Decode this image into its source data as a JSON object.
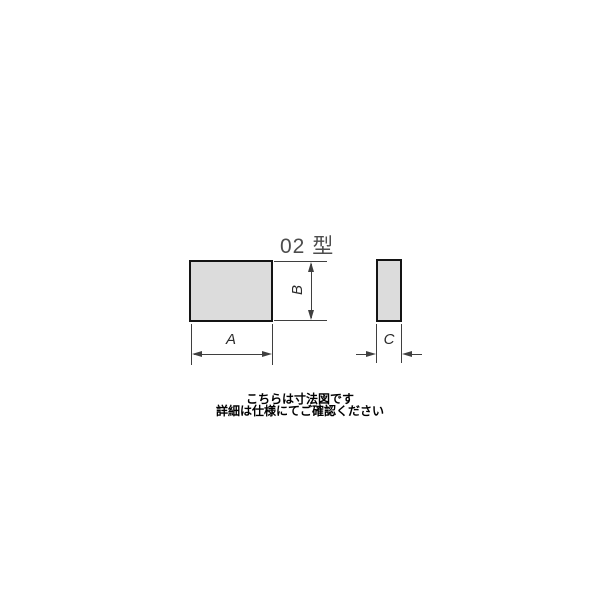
{
  "diagram": {
    "title": "02 型",
    "labels": {
      "width": "A",
      "height": "B",
      "thickness": "C"
    },
    "caption_line1": "こちらは寸法図です",
    "caption_line2": "詳細は仕様にてご確認ください",
    "colors": {
      "background": "#ffffff",
      "shape_fill": "#dcdcdc",
      "shape_border": "#141414",
      "dimension_line": "#3f3f3f",
      "title_text": "#4d4d4d",
      "caption_text": "#000000"
    }
  }
}
